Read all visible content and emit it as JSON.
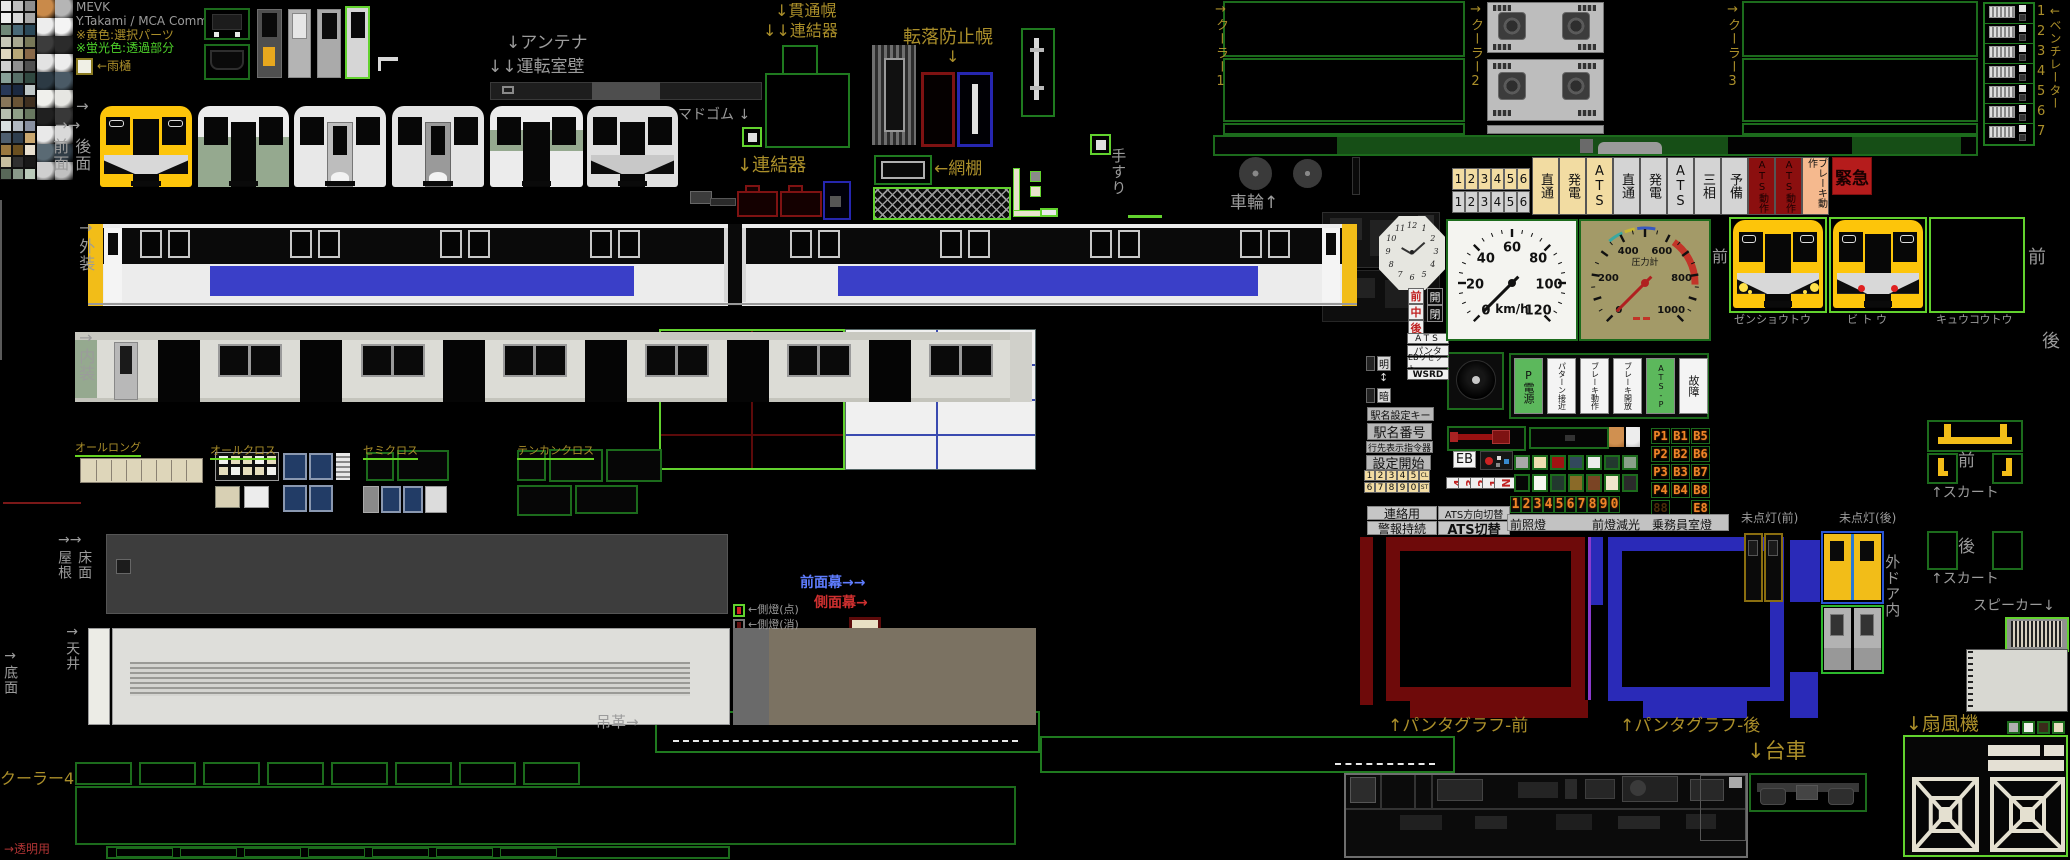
{
  "credits": {
    "title": "MEVK",
    "author": "Y.Takami / MCA Comm.",
    "note_yellow": "※黄色:選択パーツ",
    "note_fluor": "※蛍光色:透過部分",
    "rain_gutter": "←雨樋"
  },
  "labels": [
    {
      "n": "label-antenna",
      "t": "↓アンテナ",
      "x": 506,
      "y": 34,
      "c": "g",
      "s": 17
    },
    {
      "n": "label-cab-wall",
      "t": "↓↓運転室壁",
      "x": 488,
      "y": 58,
      "c": "g",
      "s": 17
    },
    {
      "n": "label-gangway-hood",
      "t": "↓貫通幌",
      "x": 775,
      "y": 2,
      "c": "o",
      "s": 16
    },
    {
      "n": "label-coupler-upper",
      "t": "↓↓連結器",
      "x": 763,
      "y": 22,
      "c": "o",
      "s": 16
    },
    {
      "n": "label-window-rubber",
      "t": "マドゴム ↓",
      "x": 678,
      "y": 108,
      "c": "g",
      "s": 14
    },
    {
      "n": "label-coupler-lower",
      "t": "↓連結器",
      "x": 737,
      "y": 156,
      "c": "o",
      "s": 18
    },
    {
      "n": "label-fall-hood",
      "t": "転落防止幌",
      "x": 903,
      "y": 28,
      "c": "o",
      "s": 18
    },
    {
      "n": "label-fall-hood-arrow",
      "t": "↓",
      "x": 946,
      "y": 48,
      "c": "o",
      "s": 16
    },
    {
      "n": "label-net-rack",
      "t": "←網棚",
      "x": 934,
      "y": 160,
      "c": "o",
      "s": 17
    },
    {
      "n": "label-handrail",
      "t": "手すり",
      "x": 1110,
      "y": 148,
      "c": "g",
      "s": 15,
      "v": 1
    },
    {
      "n": "label-cooler1",
      "t": "→クーラー1",
      "x": 1213,
      "y": 2,
      "c": "o",
      "s": 13,
      "v": 1
    },
    {
      "n": "label-cooler2",
      "t": "→クーラー2",
      "x": 1468,
      "y": 2,
      "c": "o",
      "s": 13,
      "v": 1
    },
    {
      "n": "label-cooler3",
      "t": "→クーラー3",
      "x": 1725,
      "y": 2,
      "c": "o",
      "s": 13,
      "v": 1
    },
    {
      "n": "label-ventilator",
      "t": "←ベンチレーター",
      "x": 2048,
      "y": 4,
      "c": "o",
      "s": 12,
      "v": 1
    },
    {
      "n": "label-wheels",
      "t": "車輪↑",
      "x": 1230,
      "y": 194,
      "c": "g",
      "s": 17
    },
    {
      "n": "label-face-arrow1",
      "t": "→",
      "x": 76,
      "y": 98,
      "c": "g",
      "s": 15
    },
    {
      "n": "label-face-arrow2",
      "t": "→→",
      "x": 55,
      "y": 117,
      "c": "g",
      "s": 15
    },
    {
      "n": "label-front-face",
      "t": "前面",
      "x": 51,
      "y": 138,
      "c": "g",
      "s": 16,
      "v": 1
    },
    {
      "n": "label-rear-face",
      "t": "後面",
      "x": 73,
      "y": 138,
      "c": "g",
      "s": 16,
      "v": 1
    },
    {
      "n": "label-exterior",
      "t": "→外装",
      "x": 77,
      "y": 218,
      "c": "g",
      "s": 16,
      "v": 1
    },
    {
      "n": "label-interior",
      "t": "→内装",
      "x": 77,
      "y": 328,
      "c": "g",
      "s": 16,
      "v": 1
    },
    {
      "n": "label-roof-arrows",
      "t": "→→",
      "x": 58,
      "y": 533,
      "c": "g",
      "s": 14
    },
    {
      "n": "label-roof",
      "t": "屋根",
      "x": 56,
      "y": 550,
      "c": "g",
      "s": 14,
      "v": 1
    },
    {
      "n": "label-floor",
      "t": "床面",
      "x": 76,
      "y": 550,
      "c": "g",
      "s": 14,
      "v": 1
    },
    {
      "n": "label-ceiling",
      "t": "→天井",
      "x": 64,
      "y": 624,
      "c": "g",
      "s": 14,
      "v": 1
    },
    {
      "n": "label-bottom-face",
      "t": "→底面",
      "x": 2,
      "y": 648,
      "c": "g",
      "s": 14,
      "v": 1
    },
    {
      "n": "label-cooler4",
      "t": "クーラー4",
      "x": 0,
      "y": 770,
      "c": "o",
      "s": 16
    },
    {
      "n": "label-transparent",
      "t": "→透明用",
      "x": 4,
      "y": 843,
      "c": "d",
      "s": 12
    },
    {
      "n": "label-all-long",
      "t": "オールロング",
      "x": 75,
      "y": 442,
      "c": "o",
      "s": 11,
      "u": 1
    },
    {
      "n": "label-all-cross",
      "t": "オールクロス",
      "x": 210,
      "y": 445,
      "c": "o",
      "s": 11,
      "u": 1
    },
    {
      "n": "label-semi-cross",
      "t": "セミクロス",
      "x": 363,
      "y": 445,
      "c": "o",
      "s": 11,
      "u": 1
    },
    {
      "n": "label-tenkan-cross",
      "t": "テンカンクロス",
      "x": 517,
      "y": 445,
      "c": "o",
      "s": 11,
      "u": 1
    },
    {
      "n": "label-front-curtain",
      "t": "前面幕→→",
      "x": 800,
      "y": 576,
      "c": "b",
      "s": 14
    },
    {
      "n": "label-side-curtain",
      "t": "側面幕→",
      "x": 814,
      "y": 596,
      "c": "r",
      "s": 14
    },
    {
      "n": "label-side-light-on",
      "t": "←側燈(点)",
      "x": 748,
      "y": 604,
      "c": "g",
      "s": 11
    },
    {
      "n": "label-side-light-off",
      "t": "←側燈(消)",
      "x": 748,
      "y": 619,
      "c": "g",
      "s": 11
    },
    {
      "n": "label-strap",
      "t": "吊革→",
      "x": 596,
      "y": 714,
      "c": "g",
      "s": 15
    },
    {
      "n": "label-pantograph-front",
      "t": "↑パンタグラフ-前",
      "x": 1388,
      "y": 717,
      "c": "o",
      "s": 17
    },
    {
      "n": "label-pantograph-rear",
      "t": "↑パンタグラフ-後",
      "x": 1620,
      "y": 717,
      "c": "o",
      "s": 17
    },
    {
      "n": "label-bogie",
      "t": "↓台車",
      "x": 1747,
      "y": 740,
      "c": "o",
      "s": 21
    },
    {
      "n": "label-fan",
      "t": "↓扇風機",
      "x": 1906,
      "y": 714,
      "c": "o",
      "s": 19
    },
    {
      "n": "label-headlight",
      "t": "ゼンショウトウ",
      "x": 1734,
      "y": 314,
      "c": "g",
      "s": 11
    },
    {
      "n": "label-taillight",
      "t": "ビ ト ウ",
      "x": 1847,
      "y": 314,
      "c": "g",
      "s": 11
    },
    {
      "n": "label-expresslight",
      "t": "キュウコウトウ",
      "x": 1936,
      "y": 314,
      "c": "g",
      "s": 11
    },
    {
      "n": "label-front-gauge",
      "t": "前",
      "x": 1712,
      "y": 248,
      "c": "g",
      "s": 16
    },
    {
      "n": "label-front-lights",
      "t": "前",
      "x": 2028,
      "y": 248,
      "c": "g",
      "s": 18
    },
    {
      "n": "label-rear-lights",
      "t": "後",
      "x": 2042,
      "y": 332,
      "c": "g",
      "s": 18
    },
    {
      "n": "label-skirt-front",
      "t": "↑スカート",
      "x": 1931,
      "y": 486,
      "c": "g",
      "s": 14
    },
    {
      "n": "label-skirt-rear",
      "t": "↑スカート",
      "x": 1931,
      "y": 572,
      "c": "g",
      "s": 14
    },
    {
      "n": "label-speaker",
      "t": "スピーカー↓",
      "x": 1973,
      "y": 599,
      "c": "g",
      "s": 14
    },
    {
      "n": "label-outer-door",
      "t": "外ドア内",
      "x": 1884,
      "y": 554,
      "c": "g",
      "s": 15,
      "v": 1
    },
    {
      "n": "label-unlit-front",
      "t": "未点灯(前)",
      "x": 1741,
      "y": 512,
      "c": "g",
      "s": 12
    },
    {
      "n": "label-unlit-rear",
      "t": "未点灯(後)",
      "x": 1839,
      "y": 512,
      "c": "g",
      "s": 12
    },
    {
      "n": "label-skirt-front-mae",
      "t": "前",
      "x": 1958,
      "y": 452,
      "c": "g",
      "s": 17
    },
    {
      "n": "label-skirt-rear-ushiro",
      "t": "後",
      "x": 1958,
      "y": 538,
      "c": "g",
      "s": 17
    }
  ],
  "indicator": {
    "cream_numbers": [
      "1",
      "2",
      "3",
      "4",
      "5",
      "6"
    ],
    "gray_numbers": [
      "1",
      "2",
      "3",
      "4",
      "5",
      "6"
    ],
    "buttons": [
      {
        "t": "直通",
        "s": "cream"
      },
      {
        "t": "発電",
        "s": "cream"
      },
      {
        "t": "ATS",
        "s": "cream"
      },
      {
        "t": "直通",
        "s": "gray"
      },
      {
        "t": "発電",
        "s": "gray"
      },
      {
        "t": "ATS",
        "s": "gray"
      },
      {
        "t": "三相",
        "s": "gray"
      },
      {
        "t": "予備",
        "s": "gray"
      },
      {
        "t": "ATS動作",
        "s": "dred"
      },
      {
        "t": "ATS動作",
        "s": "dred"
      },
      {
        "t": "ブレーキ動作",
        "s": "salmon"
      }
    ],
    "emergency": "緊急"
  },
  "cab": {
    "zencyugo": [
      "前",
      "中",
      "後"
    ],
    "kaihei": [
      "開",
      "閉"
    ],
    "small_buttons": [
      "ATS",
      "パンタ",
      "EBリセット",
      "WSRD"
    ],
    "meian": [
      "明",
      "暗"
    ],
    "meian_arrow": "↕"
  },
  "gauges": {
    "speed": {
      "unit": "km/h",
      "ticks": [
        0,
        20,
        40,
        60,
        80,
        100,
        120
      ],
      "max": 120,
      "value": 0
    },
    "pressure": {
      "label": "圧力計",
      "ticks": [
        0,
        200,
        400,
        600,
        800,
        1000
      ],
      "max": 1000,
      "value": 0
    },
    "clock_numerals": [
      "12",
      "1",
      "2",
      "3",
      "4",
      "5",
      "6",
      "7",
      "8",
      "9",
      "10",
      "11"
    ]
  },
  "atsp": {
    "buttons": [
      {
        "t": "P電源",
        "s": "green"
      },
      {
        "t": "パターン接近",
        "s": "white"
      },
      {
        "t": "ブレーキ動作",
        "s": "white"
      },
      {
        "t": "ブレーキ開放",
        "s": "white"
      },
      {
        "t": "ATS-P",
        "s": "green"
      },
      {
        "t": "故障",
        "s": "white"
      }
    ]
  },
  "station": {
    "key": "駅名設定キー",
    "number": "駅名番号",
    "dest": "行先表示指令器",
    "start": "設定開始",
    "keypad_row1": [
      "1",
      "2",
      "3",
      "4",
      "5",
      "CL"
    ],
    "keypad_row2": [
      "6",
      "7",
      "8",
      "9",
      "0",
      "ST"
    ],
    "eb": "EB",
    "reverser": [
      "4",
      "3",
      "2",
      "1",
      "N"
    ]
  },
  "seg": {
    "digits": [
      "1",
      "2",
      "3",
      "4",
      "5",
      "6",
      "7",
      "8",
      "9",
      "0"
    ],
    "panel": [
      [
        "P1",
        "B1",
        "B5"
      ],
      [
        "P2",
        "B2",
        "B6"
      ],
      [
        "P3",
        "B3",
        "B7"
      ],
      [
        "P4",
        "B4",
        "B8"
      ],
      [
        "88",
        "",
        "E8"
      ]
    ]
  },
  "com_buttons": [
    "連絡用",
    "ATS方向切替",
    "警報持続",
    "ATS切替"
  ],
  "light_labels": [
    "前照燈",
    "前燈減光",
    "乗務員室燈"
  ],
  "ventilator": {
    "numbers": [
      "1",
      "2",
      "3",
      "4",
      "5",
      "6",
      "7"
    ]
  },
  "colors": {
    "accent_bright_green": "#62d22e",
    "accent_dark_green": "#1c6b1c",
    "select_yellow": "#f2bd18",
    "body_blue": "#3a3fc8",
    "hood_red": "#7e1212",
    "hood_blue": "#2626b0",
    "seg_orange": "#f08428"
  },
  "palette": {
    "colors": [
      "#e8e8e8",
      "#bfbfbf",
      "#8f8f8f",
      "#efefef",
      "#d8d8d8",
      "#a8a8a8",
      "#708878",
      "#4a6a78",
      "#2a4858",
      "#c8c8b8",
      "#a8a890",
      "#787858",
      "#e0d8c0",
      "#b8a878",
      "#886848",
      "#d0d0d0",
      "#909090",
      "#505050",
      "#88a098",
      "#587068",
      "#304840",
      "#283858",
      "#1a2840",
      "#c0c8c8",
      "#88765a",
      "#6a5436",
      "#3f2f1f",
      "#b8c0b0",
      "#90a088",
      "#687860",
      "#d8e0e0",
      "#b0b8c0",
      "#8890a0",
      "#4f5f6f",
      "#2f3f4f",
      "#caa870",
      "#9a7840",
      "#6a4f20",
      "#e8e0d0",
      "#c8bfa0",
      "#303030",
      "#181818",
      "#586858",
      "#8a9a8a",
      "#bacaba"
    ],
    "tiles": [
      "#c98a4a",
      "#b5b5b5",
      "#ededed",
      "#f4f4f4",
      "#3c3c3c",
      "#2b2b2b",
      "#e3e3e3",
      "#ededed",
      "#2c3a44",
      "#4a5a66",
      "#f0f0ec",
      "#e6e6e2",
      "#202020",
      "#383838",
      "#e9e9e9",
      "#d9d9d9",
      "#5a6a74",
      "#303c46",
      "#cfcfcf",
      "#c1c1c1"
    ]
  }
}
